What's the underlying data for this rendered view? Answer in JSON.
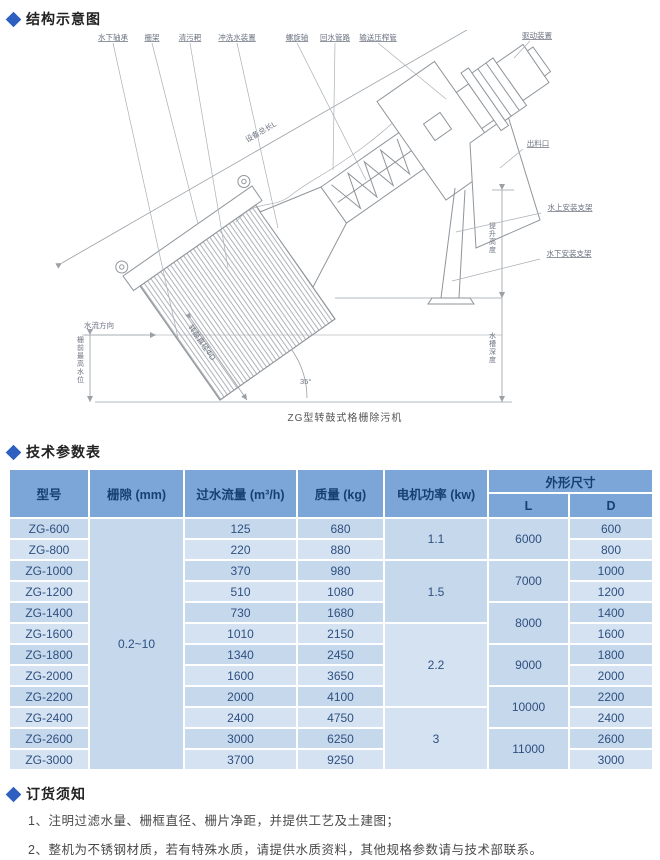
{
  "sections": {
    "structure": "结构示意图",
    "params": "技术参数表",
    "order": "订货须知"
  },
  "diagram": {
    "caption": "ZG型转鼓式格栅除污机",
    "angle_label": "35°",
    "labels": {
      "top": [
        "水下轴承",
        "栅架",
        "清污耙",
        "冲洗水装置",
        "螺旋轴",
        "回水管路",
        "输送压榨管"
      ],
      "drive": "驱动装置",
      "outlet": "出料口",
      "bracket_above": "水上安装支架",
      "bracket_below": "水下安装支架",
      "total_length": "设备总长L",
      "drum_diameter": "转鼓直径ΦD",
      "flow_direction": "水流方向",
      "water_level": "栅前最高水位",
      "lift_height": "提升高度",
      "channel_depth": "水槽深度"
    }
  },
  "table": {
    "headers": {
      "model": "型号",
      "gap": "栅隙 (mm)",
      "flow": "过水流量 (m³/h)",
      "mass": "质量 (kg)",
      "power": "电机功率 (kw)",
      "dims": "外形尺寸",
      "L": "L",
      "D": "D"
    },
    "gap_value": "0.2~10",
    "rows": [
      {
        "model": "ZG-600",
        "flow": "125",
        "mass": "680",
        "D": "600"
      },
      {
        "model": "ZG-800",
        "flow": "220",
        "mass": "880",
        "D": "800"
      },
      {
        "model": "ZG-1000",
        "flow": "370",
        "mass": "980",
        "D": "1000"
      },
      {
        "model": "ZG-1200",
        "flow": "510",
        "mass": "1080",
        "D": "1200"
      },
      {
        "model": "ZG-1400",
        "flow": "730",
        "mass": "1680",
        "D": "1400"
      },
      {
        "model": "ZG-1600",
        "flow": "1010",
        "mass": "2150",
        "D": "1600"
      },
      {
        "model": "ZG-1800",
        "flow": "1340",
        "mass": "2450",
        "D": "1800"
      },
      {
        "model": "ZG-2000",
        "flow": "1600",
        "mass": "3650",
        "D": "2000"
      },
      {
        "model": "ZG-2200",
        "flow": "2000",
        "mass": "4100",
        "D": "2200"
      },
      {
        "model": "ZG-2400",
        "flow": "2400",
        "mass": "4750",
        "D": "2400"
      },
      {
        "model": "ZG-2600",
        "flow": "3000",
        "mass": "6250",
        "D": "2600"
      },
      {
        "model": "ZG-3000",
        "flow": "3700",
        "mass": "9250",
        "D": "3000"
      }
    ],
    "power_groups": [
      {
        "value": "1.1",
        "span": 2
      },
      {
        "value": "1.5",
        "span": 3
      },
      {
        "value": "2.2",
        "span": 4
      },
      {
        "value": "3",
        "span": 3
      }
    ],
    "L_groups": [
      {
        "value": "6000",
        "span": 2
      },
      {
        "value": "7000",
        "span": 2
      },
      {
        "value": "8000",
        "span": 2
      },
      {
        "value": "9000",
        "span": 2
      },
      {
        "value": "10000",
        "span": 2
      },
      {
        "value": "11000",
        "span": 2
      }
    ]
  },
  "notes": [
    "1、注明过滤水量、栅框直径、栅片净距，并提供工艺及土建图；",
    "2、整机为不锈钢材质，若有特殊水质，请提供水质资料，其他规格参数请与技术部联系。"
  ],
  "colors": {
    "accent": "#2d5fc0",
    "header_bg": "#7ba6d7",
    "header_text": "#16406f",
    "cell_text": "#2e5080",
    "cell_bg": "#c6d8ec",
    "cell_bg_alt": "#d4e2f2"
  }
}
